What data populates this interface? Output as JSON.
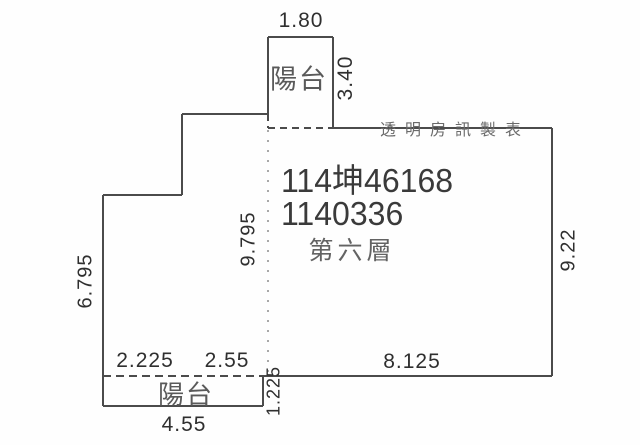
{
  "plan": {
    "watermark": "透明房訊製表",
    "unit_id_line1": "114坤46168",
    "unit_id_line2": "1140336",
    "floor_label": "第六層",
    "top_balcony_label": "陽台",
    "bottom_balcony_label": "陽台",
    "dims": {
      "top_balcony_width": "1.80",
      "top_balcony_depth": "3.40",
      "interior_height": "9.795",
      "right_wall_height": "9.22",
      "left_wall_height": "6.795",
      "bottom_segment_1": "2.225",
      "bottom_segment_2": "2.55",
      "bottom_main_wall": "8.125",
      "bottom_balcony_depth": "1.225",
      "bottom_balcony_width": "4.55"
    }
  },
  "colors": {
    "wall_line": "#4b4b4b",
    "divider_dotted": "#a8a8a8",
    "dim_text": "#2f2f2f",
    "unit_id_text": "#3a3a3a",
    "room_text": "#5a5a5a",
    "watermark_text": "#6b6b6b",
    "background": "#fefefe"
  }
}
